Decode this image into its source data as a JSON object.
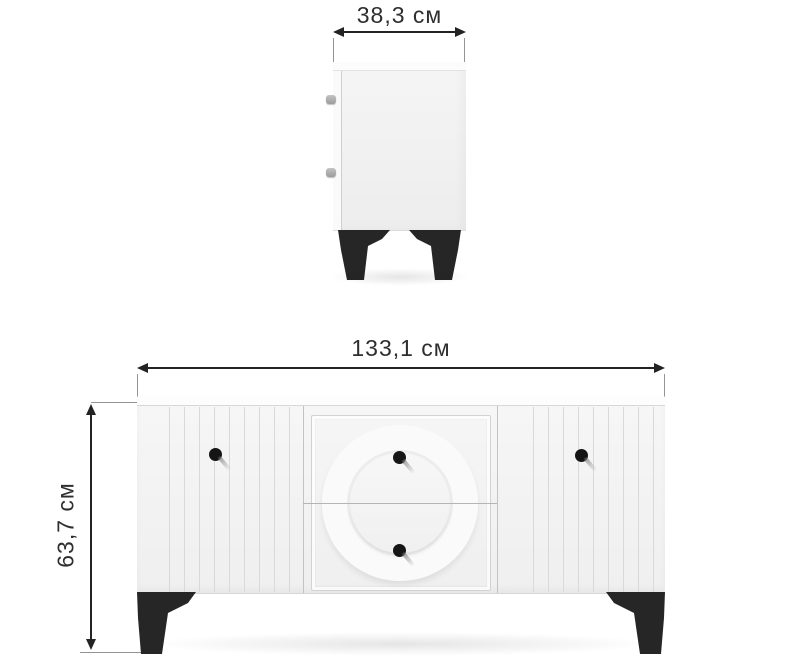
{
  "diagram": {
    "kind": "furniture-dimensions",
    "background": "#ffffff"
  },
  "dimensions": {
    "depth_label": "38,3 см",
    "width_label": "133,1 см",
    "height_label": "63,7 см"
  },
  "colors": {
    "dimension_line": "#232323",
    "extension_line": "#949494",
    "label_text": "#2e2e2e",
    "cabinet_face": "#f3f3f3",
    "cabinet_top": "#fcfcfc",
    "groove_line": "#d9d9d9",
    "panel_divider": "#c3c3c3",
    "drawer_divider": "#b5b5b5",
    "knob": "#151515",
    "leg": "#262626"
  }
}
